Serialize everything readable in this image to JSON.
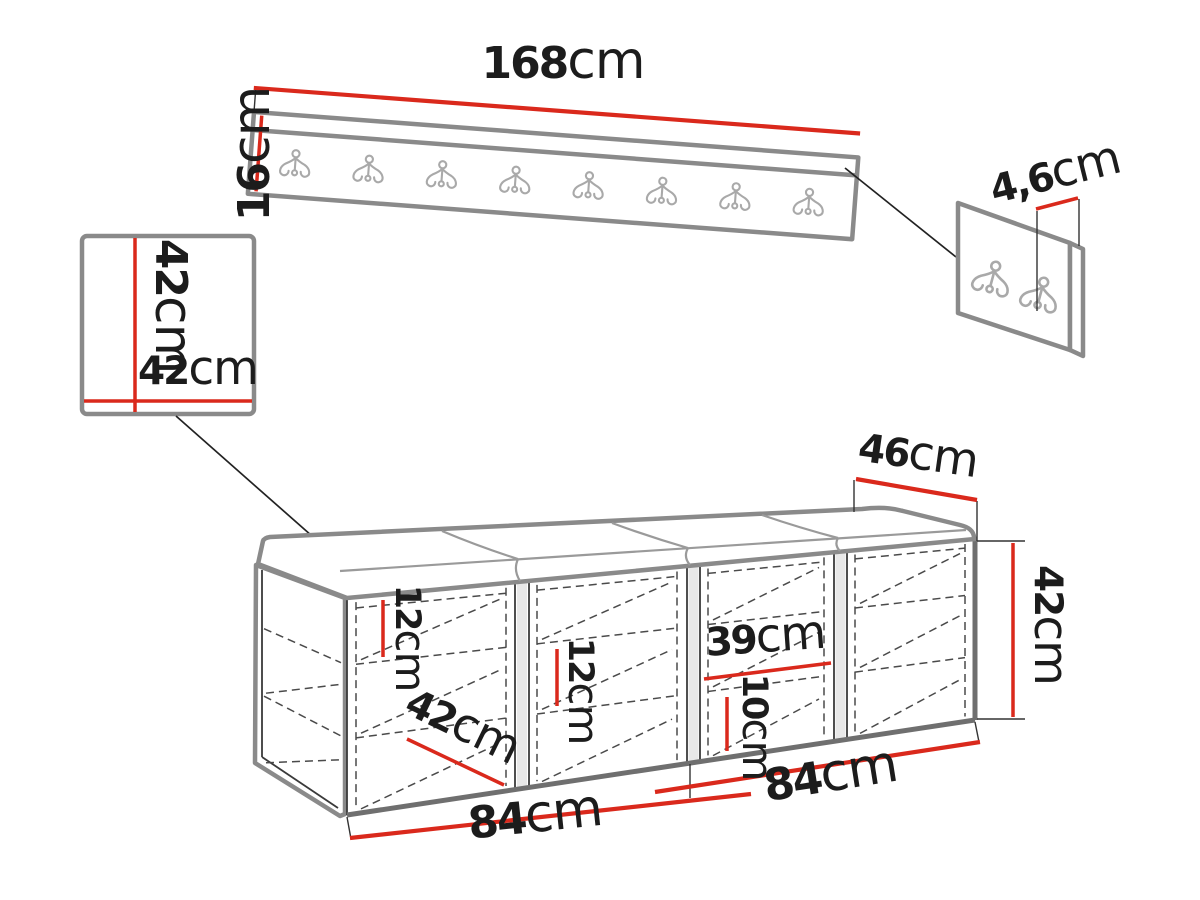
{
  "colors": {
    "dimension_red": "#da291c",
    "structure_gray": "#8a8a8a",
    "text_black": "#1c1c1c"
  },
  "views": {
    "wall_hanger_panel": {
      "hook_count": 8,
      "width": {
        "value": "168",
        "unit": "cm"
      },
      "height": {
        "value": "16",
        "unit": "cm"
      }
    },
    "square_panel": {
      "height": {
        "value": "42",
        "unit": "cm"
      },
      "width": {
        "value": "42",
        "unit": "cm"
      }
    },
    "hanger_thickness_detail": {
      "hook_count": 2,
      "thickness": {
        "value": "4,6",
        "unit": "cm"
      }
    },
    "bench": {
      "seat_count": 4,
      "depth": {
        "value": "46",
        "unit": "cm"
      },
      "height": {
        "value": "42",
        "unit": "cm"
      },
      "compartment_width": {
        "value": "39",
        "unit": "cm"
      },
      "bottom_gap": {
        "value": "10",
        "unit": "cm"
      },
      "shelf_gap_left": {
        "value": "12",
        "unit": "cm"
      },
      "shelf_gap_middle": {
        "value": "12",
        "unit": "cm"
      },
      "inner_depth": {
        "value": "42",
        "unit": "cm"
      },
      "half_width_left": {
        "value": "84",
        "unit": "cm"
      },
      "half_width_right": {
        "value": "84",
        "unit": "cm"
      }
    }
  }
}
